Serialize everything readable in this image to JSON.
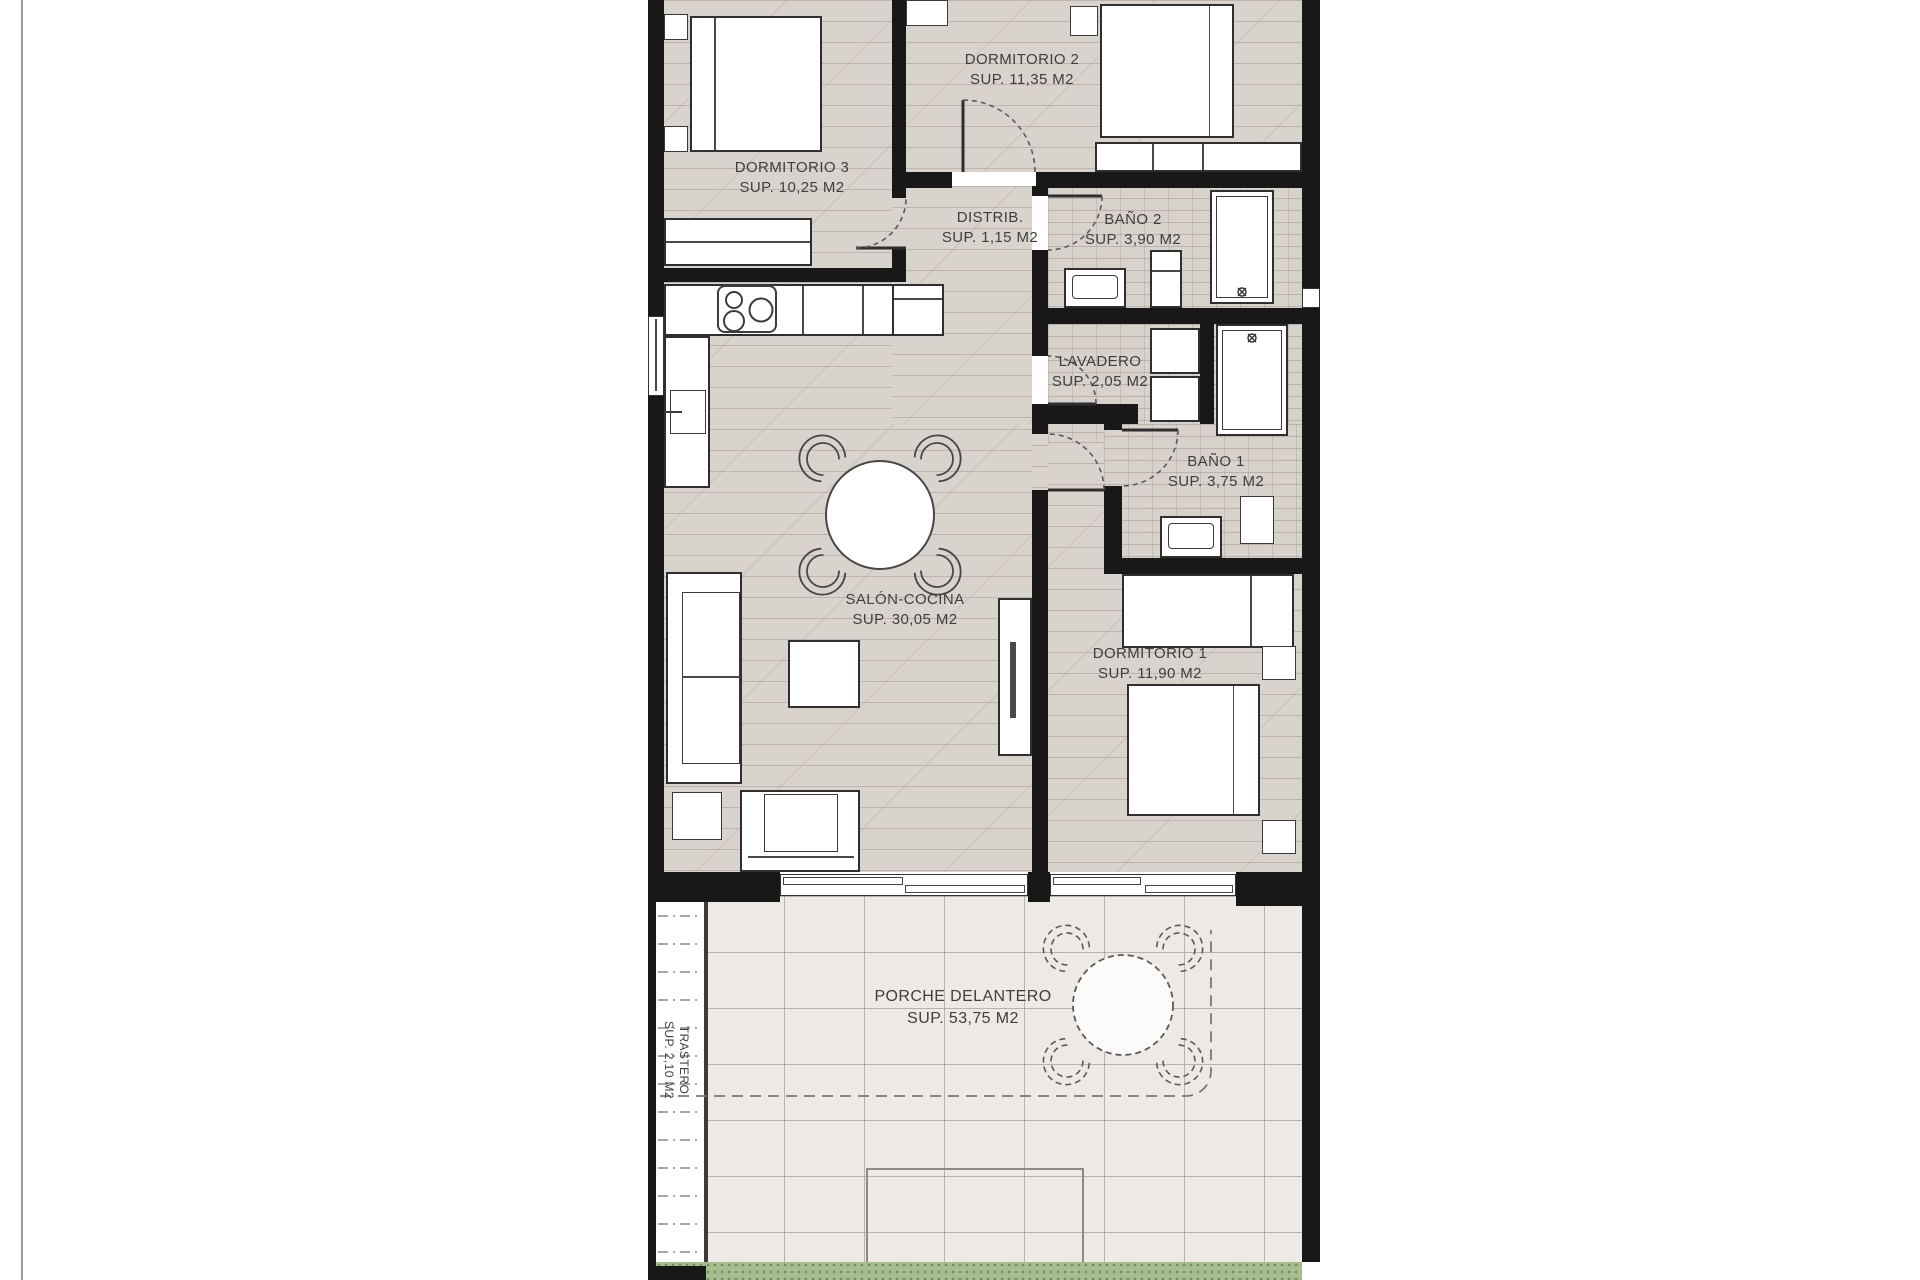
{
  "page": {
    "background": "#ffffff",
    "border_line_color": "#9a9a9a"
  },
  "colors": {
    "wall": "#181818",
    "wood_floor": "#d9d3cd",
    "tile_floor": "#d7d2cc",
    "porch_floor": "#edeae5",
    "grass": "#a6bd90",
    "furniture_fill": "#ffffff",
    "annotation_line": "#555555"
  },
  "rooms": {
    "dormitorio2": {
      "name": "DORMITORIO 2",
      "area": "SUP. 11,35 M2"
    },
    "dormitorio3": {
      "name": "DORMITORIO 3",
      "area": "SUP. 10,25 M2"
    },
    "distribuidor": {
      "name": "DISTRIB.",
      "area": "SUP. 1,15 M2"
    },
    "bano2": {
      "name": "BAÑO 2",
      "area": "SUP. 3,90 M2"
    },
    "lavadero": {
      "name": "LAVADERO",
      "area": "SUP. 2,05 M2"
    },
    "bano1": {
      "name": "BAÑO 1",
      "area": "SUP. 3,75 M2"
    },
    "salon_cocina": {
      "name": "SALÓN-COCINA",
      "area": "SUP. 30,05 M2"
    },
    "dormitorio1": {
      "name": "DORMITORIO 1",
      "area": "SUP. 11,90 M2"
    },
    "porche": {
      "name": "PORCHE DELANTERO",
      "area": "SUP. 53,75 M2"
    },
    "trastero": {
      "name": "TRASTERO",
      "area": "SUP. 2,10 M2"
    }
  }
}
